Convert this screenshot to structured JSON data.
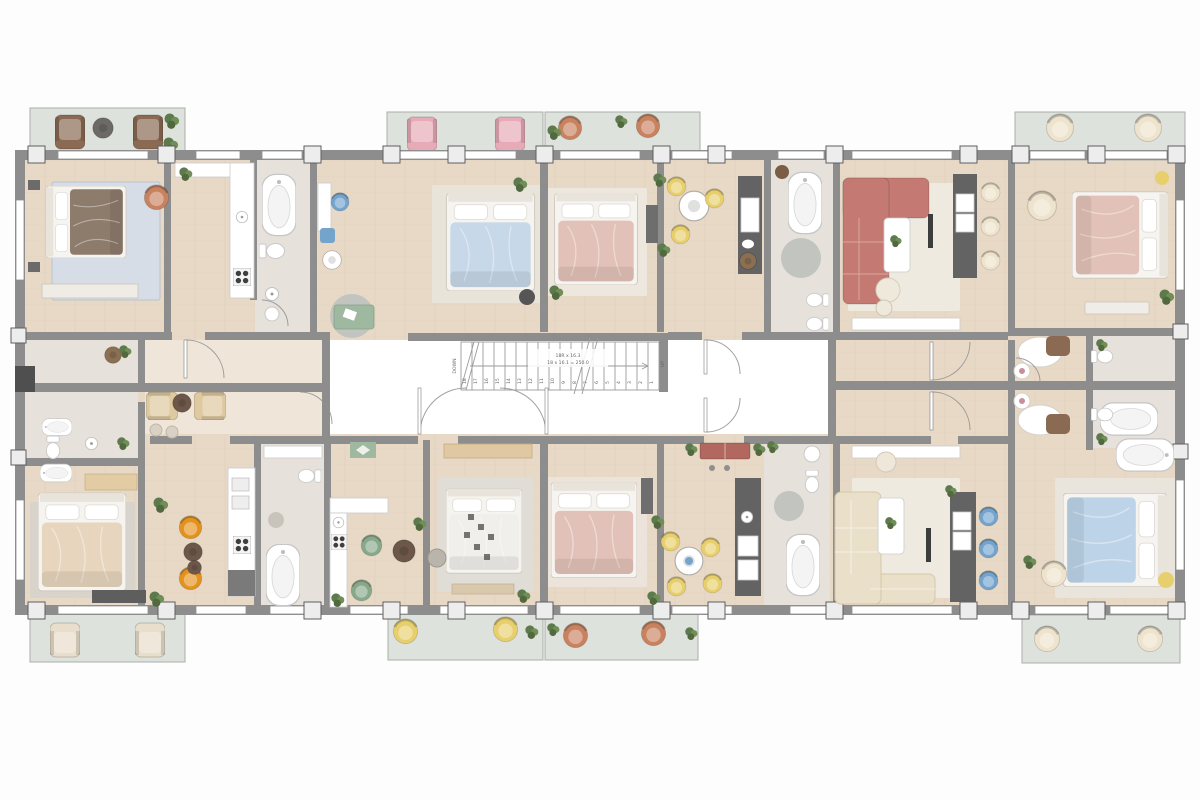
{
  "stairs": {
    "down_label": "DOWN",
    "up_label": "UP",
    "annotation_line1": "18R x 16.3",
    "annotation_line2": "18 x 16.1 = 250.0",
    "tread_count": 18,
    "tread_numbers": [
      "1",
      "2",
      "3",
      "4",
      "5",
      "6",
      "7",
      "8",
      "9",
      "10",
      "11",
      "12",
      "13",
      "14",
      "15",
      "16",
      "17",
      "18"
    ]
  },
  "palette": {
    "wall": "#8d8d8d",
    "wallDark": "#555555",
    "column": "#ededed",
    "windowFill": "#ffffff",
    "floorWood": "#e7d9c6",
    "floorPale": "#efe6d9",
    "floorMarble": "#e6e1da",
    "balconyFloor": "#dee2dd",
    "rugCream": "#efeae0",
    "rugGray": "#c2c4c0",
    "rugBlue": "#d7dde6",
    "wood": "#7b5c45",
    "plant": "#5d7a4d",
    "bedBrown": "#8d7b6c",
    "bedBlue": "#c7d8e8",
    "bedPink": "#e2c2b8",
    "bedWhite": "#f1efeb",
    "bedCream": "#e7d6bd",
    "bedSky": "#bcd3e8",
    "sofaRed": "#c47a72",
    "sofaCream": "#eadfc8",
    "chairPink": "#e7abb8",
    "chairTerracotta": "#c8825f",
    "chairYellow": "#e8cf6e",
    "chairOrange": "#e3921e",
    "chairGreen": "#87a98a",
    "chairBlue": "#74a3cc",
    "chairCream": "#eee3cc",
    "chairBrown": "#8a6a52",
    "chairBeige": "#dfc9a0",
    "counterDark": "#636363",
    "counterWhite": "#ffffff",
    "benchGreen": "#9fb8a0",
    "benchRed": "#b2685f",
    "lineGray": "#9b9b9b",
    "textGray": "#666666"
  }
}
